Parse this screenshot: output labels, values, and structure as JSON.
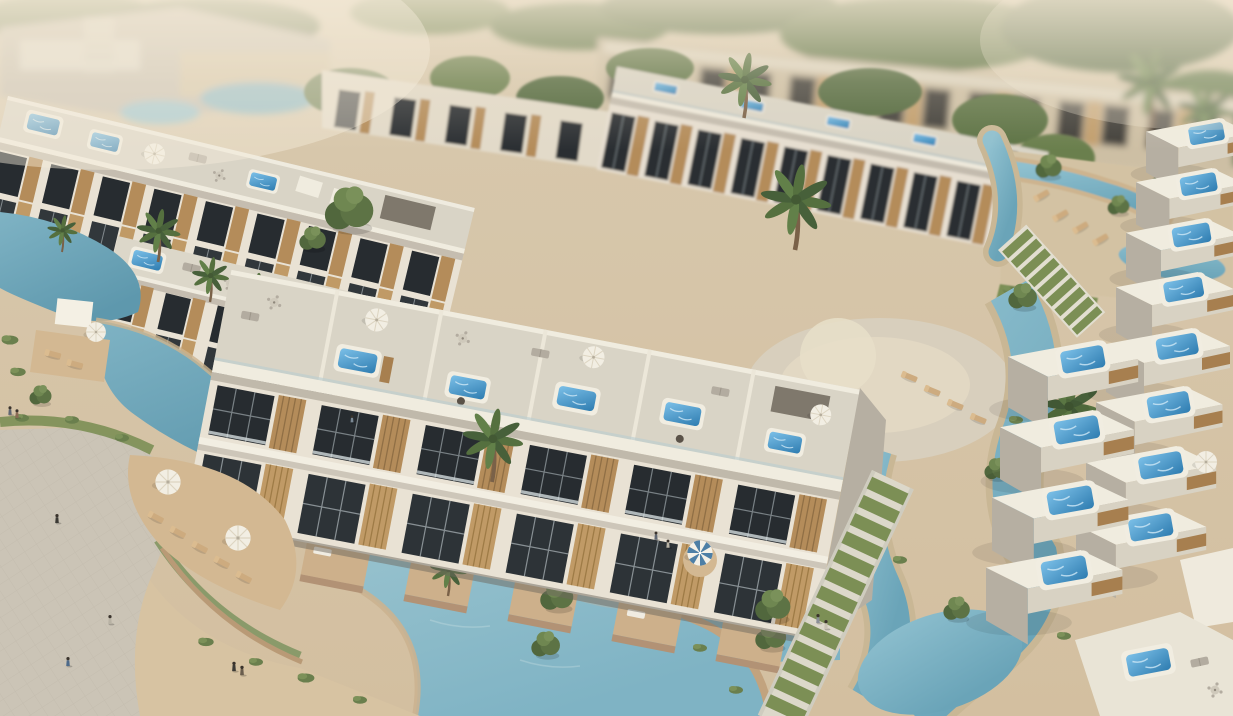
{
  "scene": {
    "type": "aerial-3d-architectural-render",
    "subject": "Aerial tilt-shift 3D rendering of a modern resort residential complex: rows of white townhouses with rooftop jacuzzis and umbrellas, turquoise lagoon pools, sandy decks with sun loungers, palm trees, grass staircases and people walking on a cobbled plaza",
    "style": "tilt-shift, warm afternoon light, blurred far background",
    "palette": {
      "ground_sand": "#d8c9ae",
      "ground_sand_deep": "#d3bfa0",
      "plaza_cobble": "#cbc4b6",
      "cobble_line": "#b9b2a4",
      "deck_sand": "#d3b892",
      "water_light": "#a3c9d2",
      "water_mid": "#7fb3c4",
      "water_deep": "#5e98ad",
      "jacuzzi_light": "#7cc0e8",
      "jacuzzi_deep": "#2e7cb0",
      "jacuzzi_rim": "#f1ede1",
      "building_face": "#e9e2d4",
      "building_side": "#b6afa2",
      "roof_deck": "#d9d4c6",
      "parapet": "#f0ecdf",
      "wood_slat": "#b48c5a",
      "wood_slat_dark": "#8a6a42",
      "glass_dark": "#272c30",
      "far_facade": "#cdbfa4",
      "far_window": "#43403a",
      "palm_green": "#55703f",
      "tree_green": "#5d7345",
      "bush_green": "#6a7f4d",
      "grass_steps": "#7c8f55",
      "step_stone": "#e2ded0",
      "trunk_brown": "#7a6148",
      "umbrella_canvas": "#f2eee3",
      "parasol_stripe_blue": "#4d7fa6",
      "lounger_wood": "#cdab7f",
      "retaining_wall": "#c2a37e",
      "haze_warm": "#f2e7d3"
    },
    "inventory": {
      "townhouse_rows": 6,
      "rooftop_jacuzzis": 22,
      "white_umbrellas": 9,
      "striped_parasols": 1,
      "shade_sails": 3,
      "palm_trees": 12,
      "lagoon_pools": 5,
      "water_channels": 3,
      "grass_staircases": 2,
      "sun_loungers": 16,
      "people": 11
    }
  }
}
